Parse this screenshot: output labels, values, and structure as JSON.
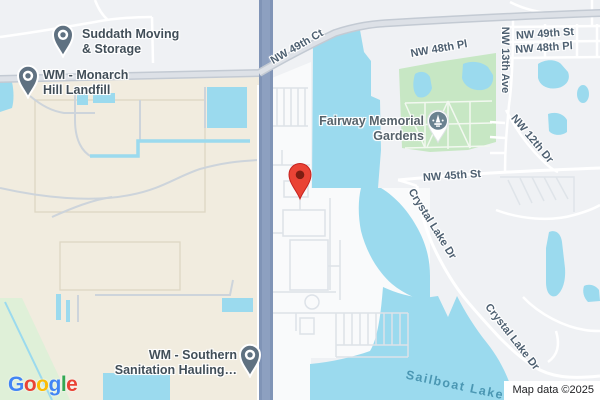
{
  "map": {
    "pois": {
      "suddath": {
        "line1": "Suddath Moving",
        "line2": "& Storage"
      },
      "monarch": {
        "line1": "WM - Monarch",
        "line2": "Hill Landfill"
      },
      "southern": {
        "line1": "WM - Southern",
        "line2": "Sanitation Hauling…"
      },
      "fairway": {
        "line1": "Fairway Memorial",
        "line2": "Gardens"
      }
    },
    "road_labels": {
      "nw49ct": "NW 49th Ct",
      "nw48pl_center": "NW 48th Pl",
      "nw49st": "NW 49th St",
      "nw48pl_right": "NW 48th Pl",
      "nw13ave": "NW 13th Ave",
      "nw12dr": "NW 12th Dr",
      "nw45st": "NW 45th St",
      "crystal_lake_upper": "Crystal Lake Dr",
      "crystal_lake_lower": "Crystal Lake Dr"
    },
    "water_labels": {
      "sailboat": "Sailboat Lake"
    },
    "markers": {
      "red_pin": "dropped-pin",
      "suddath_pin": "place-pin",
      "monarch_pin": "place-pin",
      "southern_pin": "place-pin",
      "cemetery_badge": "cemetery-icon"
    },
    "attribution": {
      "text": "Map data ©2025"
    },
    "logo": {
      "name": "Google",
      "letters": [
        {
          "ch": "G",
          "color": "#4285F4"
        },
        {
          "ch": "o",
          "color": "#EA4335"
        },
        {
          "ch": "o",
          "color": "#FBBC05"
        },
        {
          "ch": "g",
          "color": "#4285F4"
        },
        {
          "ch": "l",
          "color": "#34A853"
        },
        {
          "ch": "e",
          "color": "#EA4335"
        }
      ]
    },
    "colors": {
      "water": "#9bdaee",
      "park": "#c7e7c4",
      "grass": "#dff0d8",
      "industrial": "#f1ecdf",
      "base": "#eff1f4",
      "built": "#f9fafb",
      "highway": "#8094b6",
      "road_fill": "#d9dee4",
      "road_label": "#4e6071",
      "poi_label": "#414e58",
      "water_label": "#4b97b3",
      "pin_red": "#EA4335",
      "pin_gray": "#5f7181"
    }
  }
}
